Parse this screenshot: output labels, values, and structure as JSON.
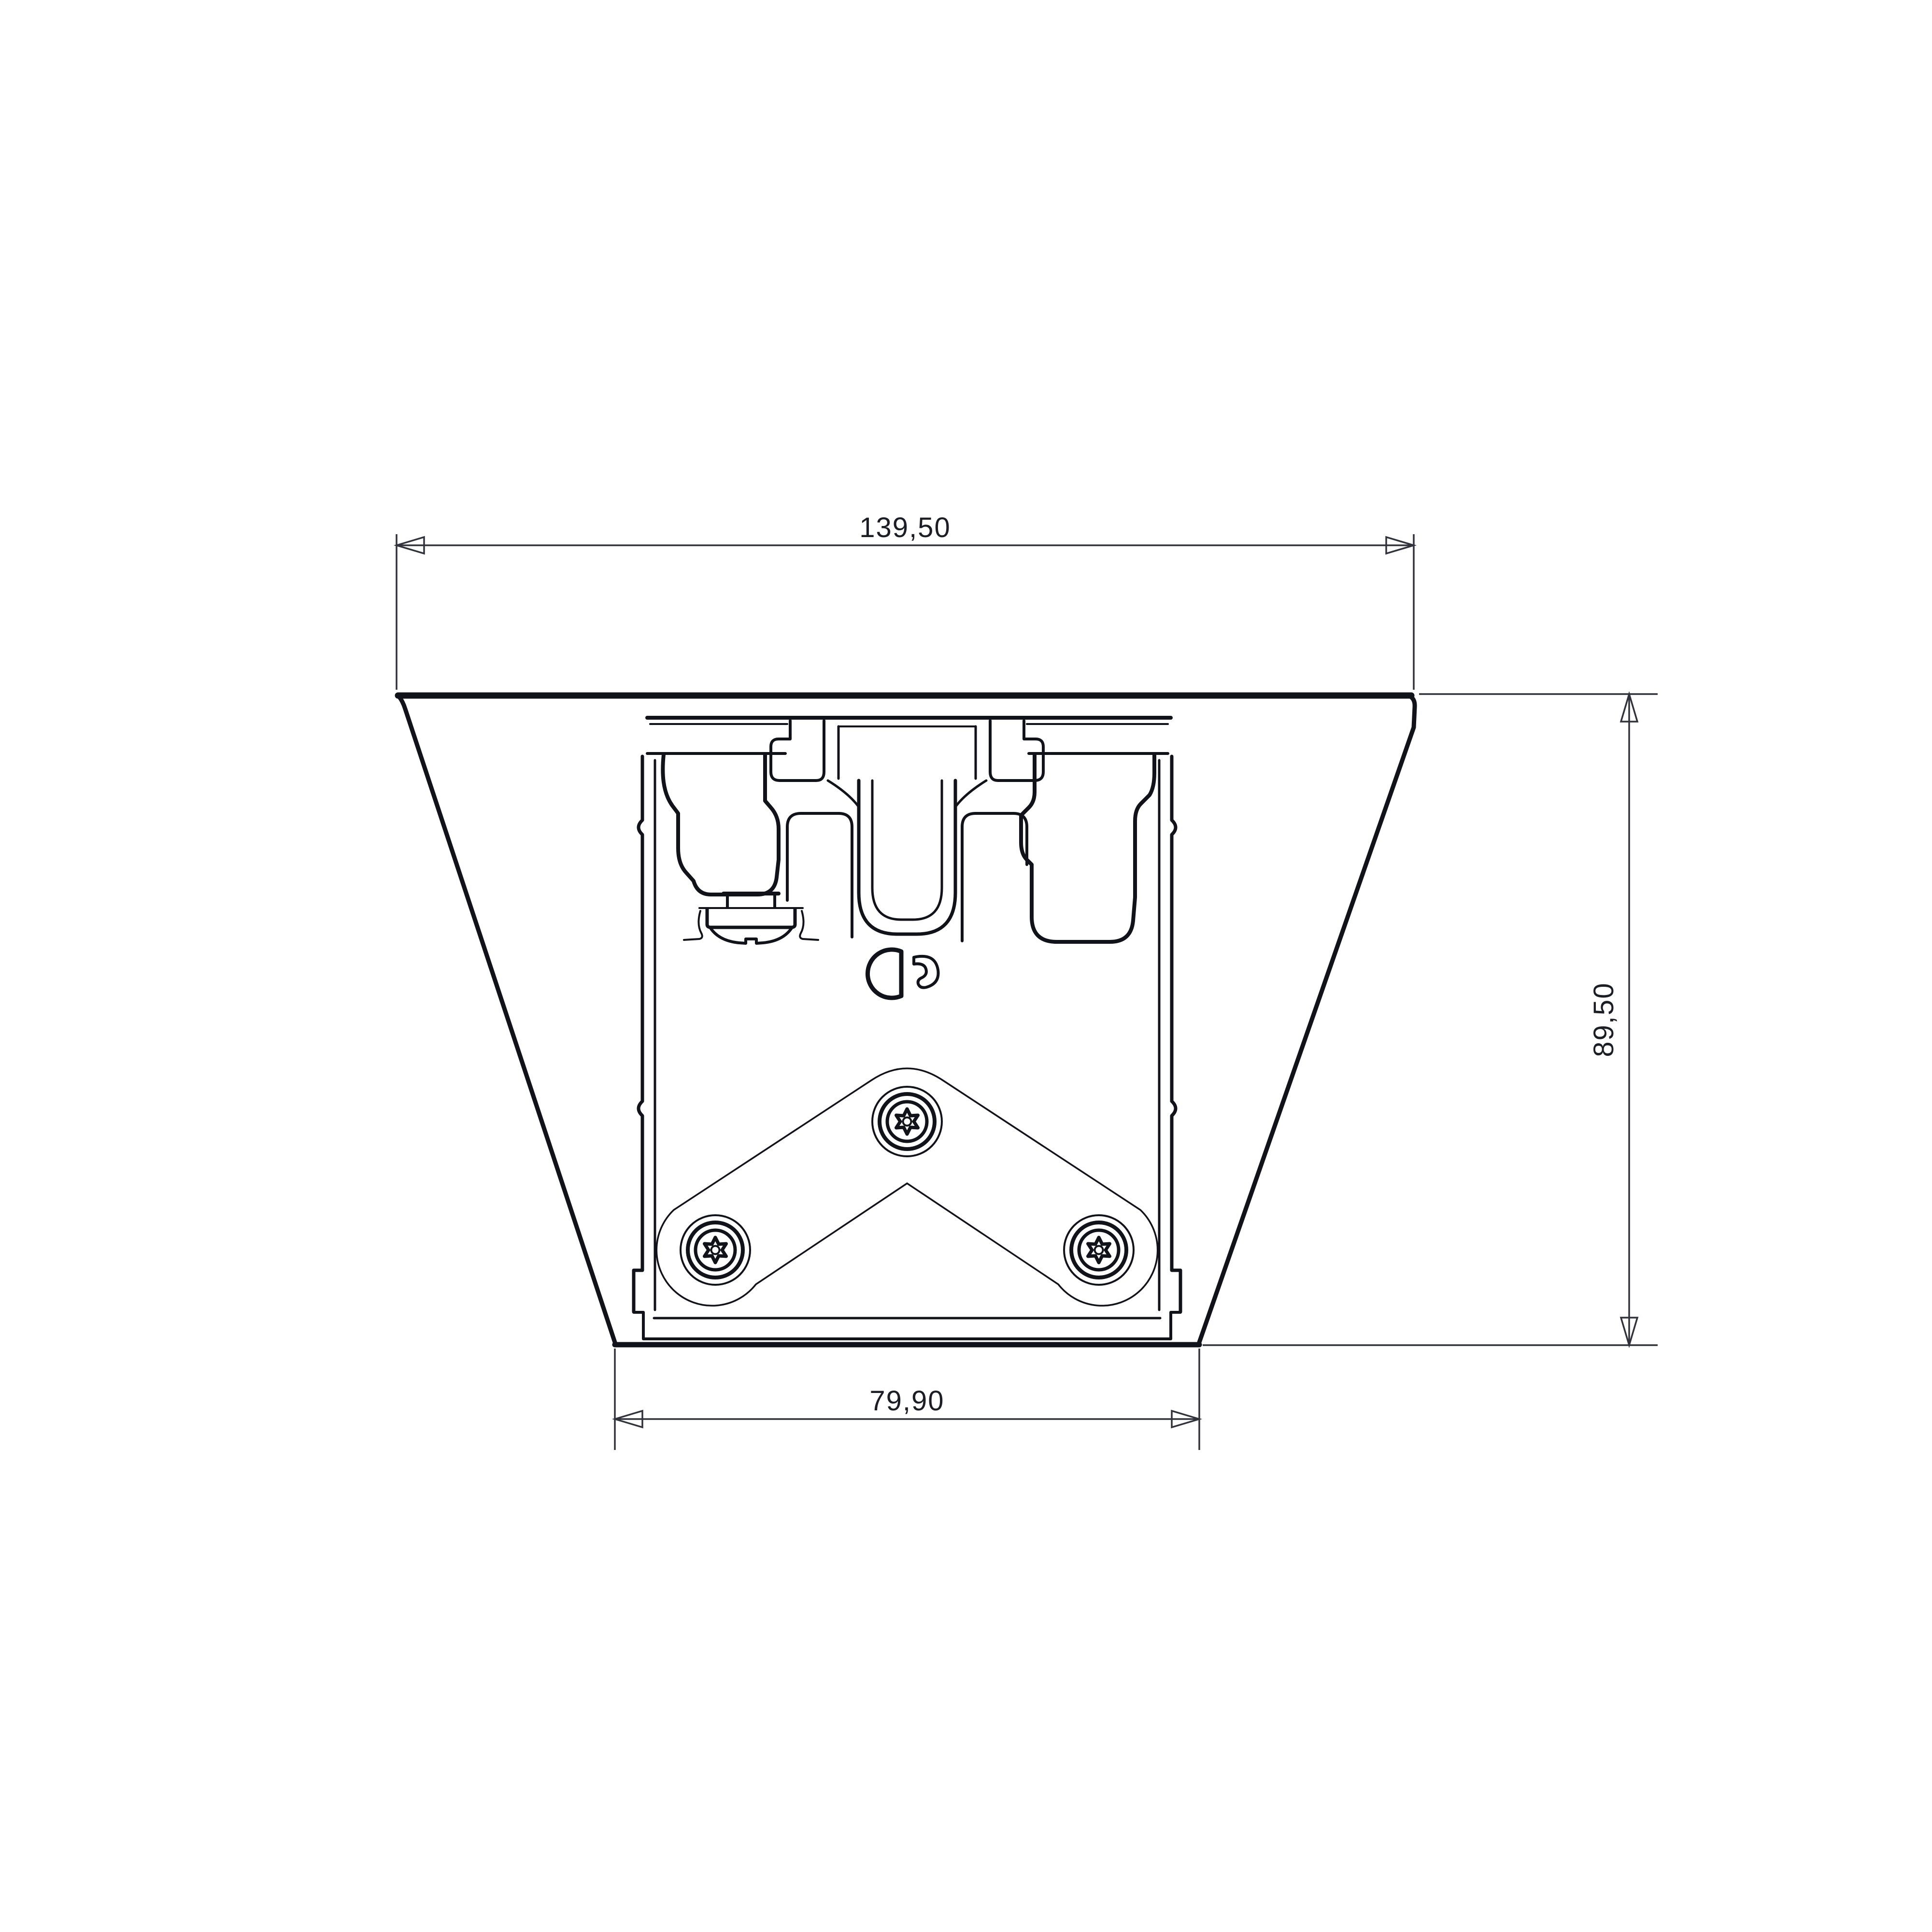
{
  "drawing": {
    "type": "technical-drawing",
    "view": "front elevation / section of ceiling-mount bracket with extrusion rail",
    "dimensions": {
      "top_width": "139,50",
      "height": "89,50",
      "bottom_width": "79,90"
    },
    "features": [
      "trapezoid-housing-outline",
      "mounting-plate",
      "extrusion-rail-profile",
      "hook-claw-left",
      "hook-claw-right",
      "center-u-channel",
      "washer-screw-side-view",
      "keyhole-slot",
      "chevron-link-plate",
      "torx-screw-top",
      "torx-screw-left",
      "torx-screw-right"
    ],
    "colors": {
      "line": "#12121a",
      "dimension": "#32323c",
      "text": "#1d1d26",
      "background": "#ffffff"
    }
  }
}
